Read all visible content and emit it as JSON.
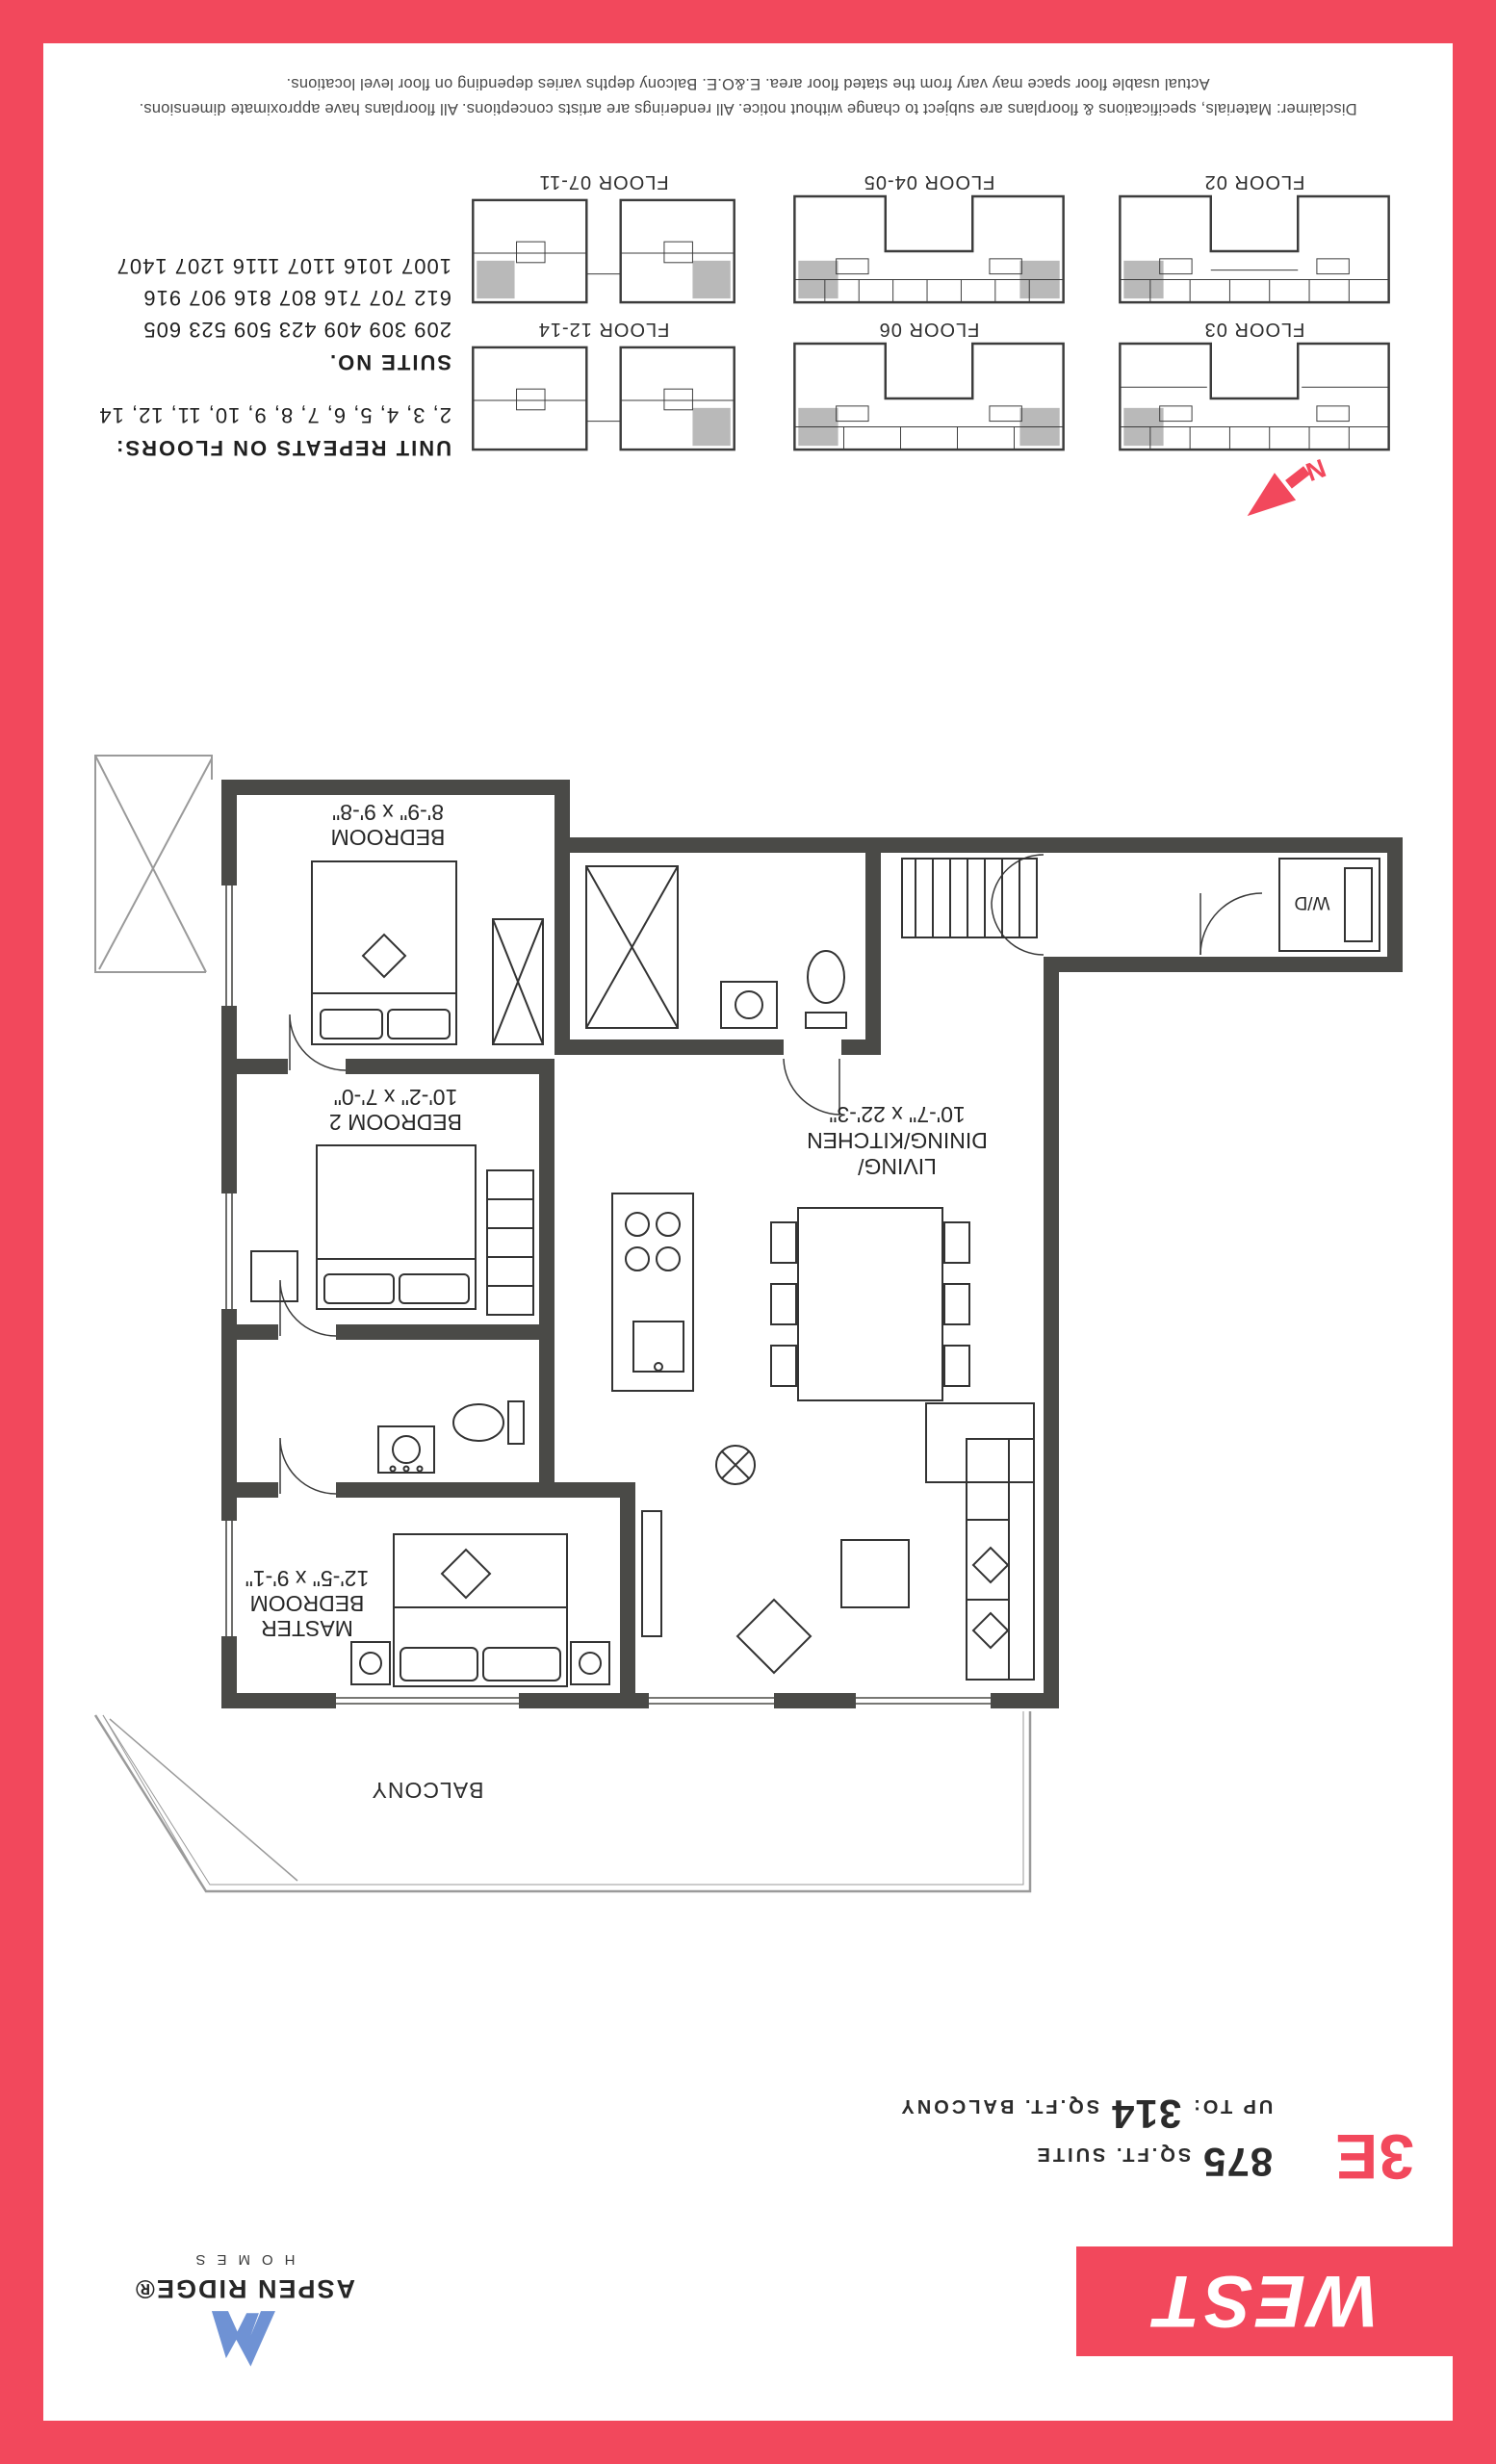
{
  "document": {
    "west_label": "WEST",
    "brand": {
      "name": "ASPEN RIDGE®",
      "sub": "HOMES"
    },
    "suite": {
      "code": "3E",
      "area_value": "875",
      "area_label": "SQ.FT. SUITE",
      "balcony_prefix": "UP TO:",
      "balcony_value": "314",
      "balcony_label": "SQ.FT. BALCONY"
    }
  },
  "floorplan": {
    "master": {
      "l1": "MASTER",
      "l2": "BEDROOM",
      "dims": "12'-5\" x 9'-1\""
    },
    "bedroom2": {
      "l1": "BEDROOM 2",
      "dims": "10'-2\" x 7'-0\""
    },
    "bedroom": {
      "l1": "BEDROOM",
      "dims": "8'-9\" x 9'-8\""
    },
    "living": {
      "l1": "LIVING/",
      "l2": "DINING/KITCHEN",
      "dims": "10'-7\" x 22'-3\""
    },
    "balcony_label": "BALCONY",
    "wd_label": "W/D",
    "north_label": "N"
  },
  "keyplans": {
    "labels": [
      "FLOOR 03",
      "FLOOR 02",
      "FLOOR 06",
      "FLOOR 04-05",
      "FLOOR 12-14",
      "FLOOR 07-11"
    ]
  },
  "unit_repeats": {
    "title": "UNIT REPEATS ON FLOORS:",
    "floors": "2, 3, 4, 5, 6, 7, 8, 9, 10, 11, 12, 14"
  },
  "suite_numbers": {
    "title": "SUITE NO.",
    "rows": [
      "209 309 409 423 509 523 605",
      "612 707 716 807 816 907 916",
      "1007 1016 1107 1116 1207 1407"
    ]
  },
  "disclaimer": {
    "line1": "Disclaimer: Materials, specifications & floorplans are subject to change without notice. All renderings are artists conceptions. All floorplans have approximate dimensions.",
    "line2": "Actual usable floor space may vary from the stated floor area. E.&O.E. Balcony depths varies depending on floor level locations."
  },
  "colors": {
    "accent_pink": "#f2485c",
    "wall_gray": "#4a4a47",
    "logo_blue": "#6f92d4",
    "unit_shade_gray": "#b9b9b9"
  },
  "icons": {
    "north_arrow": "compass-north-arrow",
    "brand_mark": "mountain-peak-logo"
  }
}
